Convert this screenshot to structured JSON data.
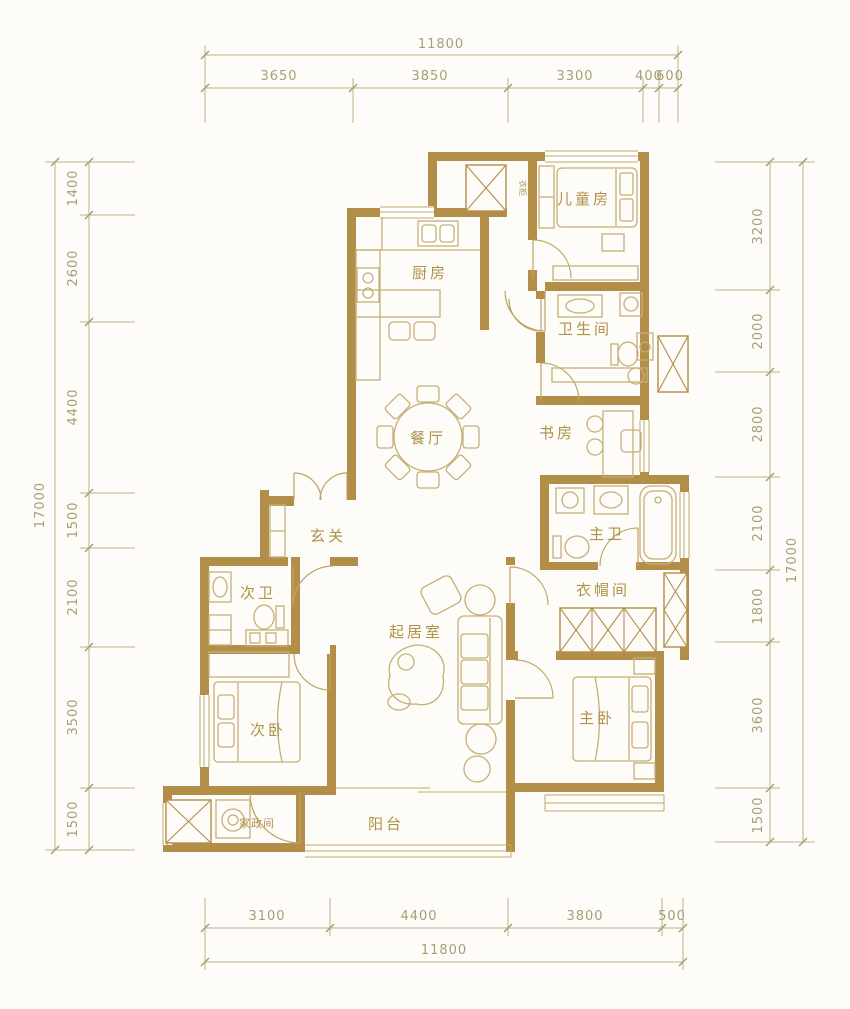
{
  "plan_title": "三室两厅户型图",
  "colors": {
    "wall": "#b28e49",
    "furniture": "#c7ae76",
    "dimension": "#a89d73",
    "label": "#b09148",
    "background": "#fdfcf9"
  },
  "rooms": {
    "kitchen": "厨房",
    "children": "儿童房",
    "bathroom": "卫生间",
    "dining": "餐厅",
    "study": "书房",
    "foyer": "玄关",
    "second_bath": "次卫",
    "living": "起居室",
    "master_bath": "主卫",
    "cloakroom": "衣帽间",
    "second_bedroom": "次卧",
    "master_bedroom": "主卧",
    "housekeeping": "家政间",
    "balcony": "阳台",
    "wardrobe": "衣柜"
  },
  "dimensions": {
    "top": {
      "total": "11800",
      "segments": [
        "3650",
        "3850",
        "3300",
        "400",
        "600"
      ]
    },
    "bottom": {
      "total": "11800",
      "segments": [
        "3100",
        "4400",
        "3800",
        "500"
      ]
    },
    "left": {
      "total": "17000",
      "segments": [
        "1400",
        "2600",
        "4400",
        "1500",
        "2100",
        "3500",
        "1500"
      ]
    },
    "right": {
      "total": "17000",
      "segments": [
        "3200",
        "2000",
        "2800",
        "2100",
        "1800",
        "3600",
        "1500"
      ]
    }
  }
}
